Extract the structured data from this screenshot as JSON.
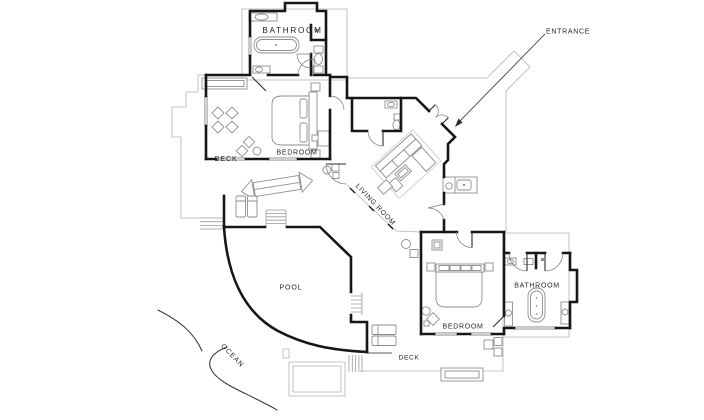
{
  "figure": {
    "type": "floor-plan",
    "background": "#ffffff"
  },
  "colors": {
    "walls": "#161616",
    "roof_outline": "#b4b4b4",
    "furniture": "#8e8e8e",
    "text": "#262626"
  },
  "labels": {
    "bathroom_top": "BATHROOM",
    "entrance": "ENTRANCE",
    "bedroom_left": "BEDROOM",
    "deck_left": "DECK",
    "living_room": "LIVING ROOM",
    "pool": "POOL",
    "ocean": "OCEAN",
    "bedroom_right": "BEDROOM",
    "bathroom_right": "BATHROOM",
    "deck_bottom": "DECK"
  }
}
